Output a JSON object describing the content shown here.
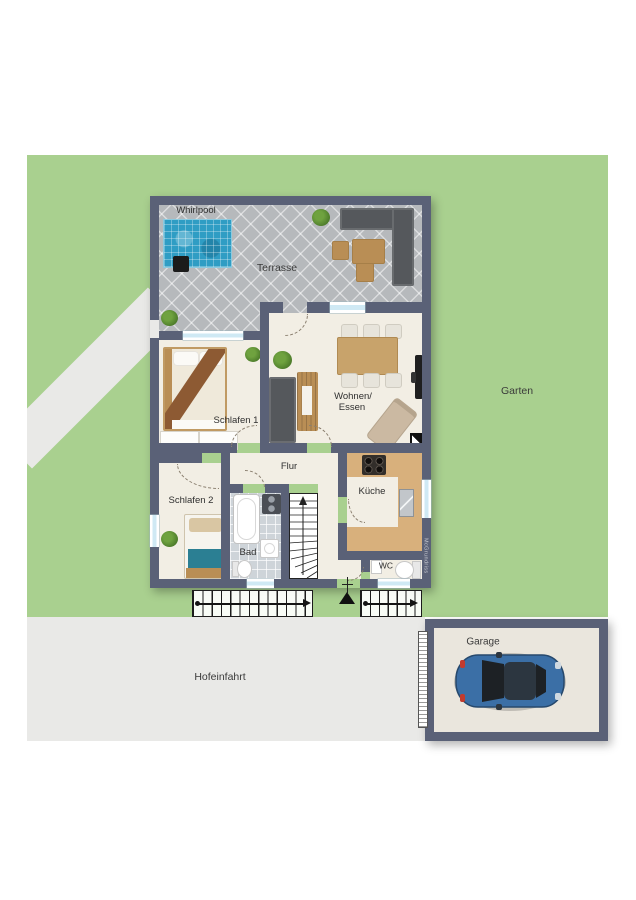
{
  "plan": {
    "labels": {
      "whirlpool": "Whirlpool",
      "terrasse": "Terrasse",
      "schlafen1": "Schlafen 1",
      "wohnen_essen_line1": "Wohnen/",
      "wohnen_essen_line2": "Essen",
      "flur": "Flur",
      "schlafen2": "Schlafen 2",
      "bad": "Bad",
      "kueche": "Küche",
      "wc": "WC",
      "garten": "Garten",
      "hofeinfahrt": "Hofeinfahrt",
      "garage": "Garage",
      "watermark": "McGrundriss"
    },
    "colors": {
      "garden": "#a9d08f",
      "pavement": "#e9e9e7",
      "wall": "#5a6177",
      "floor": "#f2eee4",
      "terrace": "#b6b9bc",
      "bath": "#ced4d9",
      "pool": "#2f9dc4",
      "window": "#cfe9f4",
      "wood": "#b98e55",
      "counter": "#d8b07c",
      "chair": "#e7e4db",
      "sofa": "#55585c",
      "teal": "#2b7f93",
      "blanket": "#8d5a33",
      "car": "#3b6fa6"
    }
  }
}
